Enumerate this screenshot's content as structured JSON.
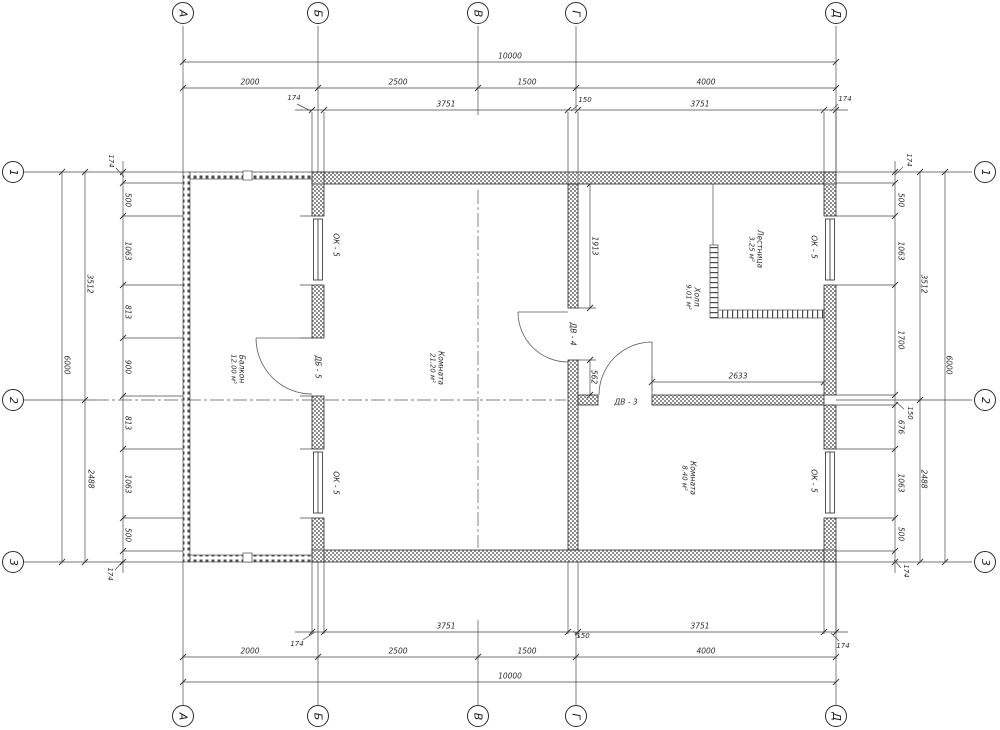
{
  "sheet": {
    "background": "#ffffff",
    "line_color": "#3d3d3d",
    "wall_hatch_color": "#8f8f8f"
  },
  "axes": {
    "cols": [
      "А",
      "Б",
      "В",
      "Г",
      "Д"
    ],
    "rows": [
      "1",
      "2",
      "3"
    ]
  },
  "dims": {
    "overall_width": "10000",
    "overall_height": "6000",
    "col_spans": [
      "2000",
      "2500",
      "1500",
      "4000"
    ],
    "top_chain": {
      "wall_left": "174",
      "span_left": "3751",
      "wall_mid": "150",
      "span_right": "3751",
      "wall_right": "174"
    },
    "row_spans": [
      "3512",
      "2488"
    ],
    "left_chain": [
      "174",
      "500",
      "1063",
      "813",
      "900",
      "813",
      "1063",
      "500",
      "174"
    ],
    "right_chain": [
      "174",
      "500",
      "1063",
      "1700",
      "150",
      "676",
      "1063",
      "500",
      "174"
    ],
    "hall_width": "2633",
    "door_top_offset": "1913",
    "door_bottom_offset": "562"
  },
  "rooms": [
    {
      "name": "Балкон",
      "area": "12.00 м²"
    },
    {
      "name": "Комната",
      "area": "21.20 м²"
    },
    {
      "name": "Лестница",
      "area": "3.25 м²"
    },
    {
      "name": "Холл",
      "area": "9.01 м²"
    },
    {
      "name": "Комната",
      "area": "8.40 м²"
    }
  ],
  "openings": {
    "window": "ОК - 5",
    "balcony_door": "ДБ - 5",
    "room_door": "ДВ - 4",
    "hall_door": "ДВ - 3"
  }
}
